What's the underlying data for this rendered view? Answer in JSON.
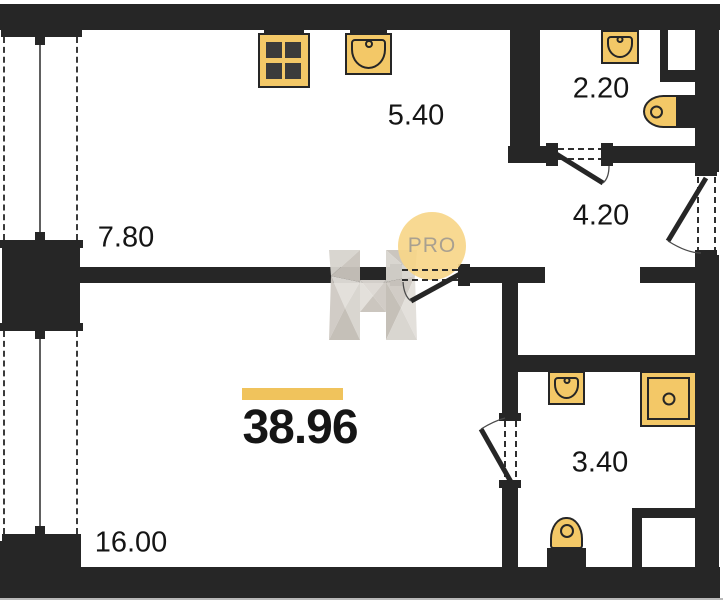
{
  "total": {
    "area": "38.96"
  },
  "rooms": {
    "dining": {
      "area": "7.80"
    },
    "kitchen": {
      "area": "5.40"
    },
    "bathroom_top": {
      "area": "2.20"
    },
    "hallway": {
      "area": "4.20"
    },
    "bathroom_bottom": {
      "area": "3.40"
    },
    "living": {
      "area": "16.00"
    }
  },
  "watermark": {
    "label": "PRO"
  },
  "fixtures": [
    "stove-4-burner-icon",
    "kitchen-sink-icon",
    "bathroom-sink-icon",
    "toilet-icon",
    "shower-tray-icon",
    "toilet-icon",
    "bathroom-sink-icon"
  ],
  "colors": {
    "wall": "#262626",
    "line": "#3a3a3a",
    "fixture": "#F3C867",
    "fixture_dark": "#3b3b3b",
    "highlight": "#F0C35C",
    "pro_bg": "#F8D78A",
    "pro_text": "#A39988",
    "label": "#151515",
    "bg": "#FFFFFF",
    "edge": "#b9b9b9",
    "h1": "#D8D4CE",
    "h2": "#C9C4BC",
    "h3": "#E2DFDA",
    "h4": "#CFCAC3",
    "h5": "#C2BDB5",
    "h6": "#DDD9D3"
  }
}
